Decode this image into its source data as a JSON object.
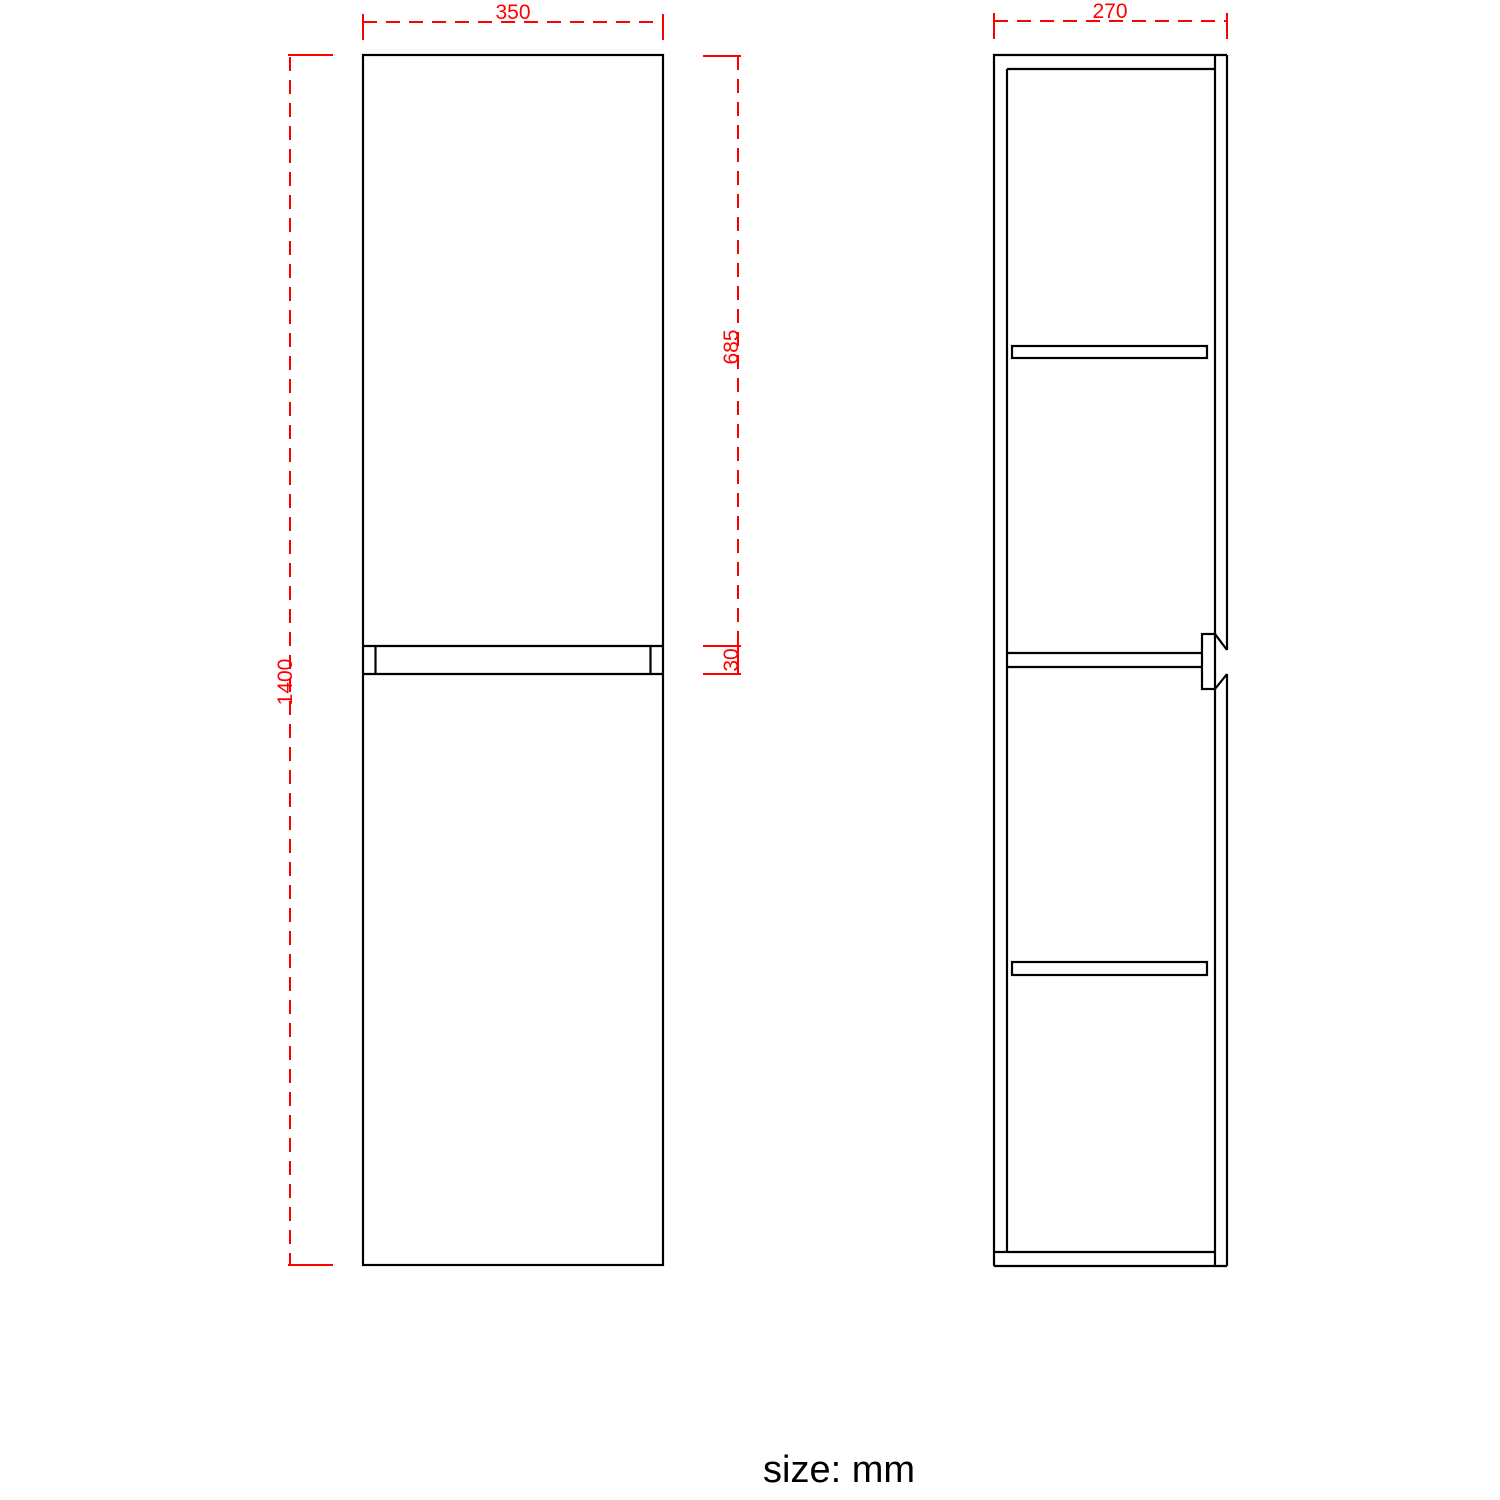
{
  "drawing": {
    "dimensions": {
      "front_width_mm": "350",
      "front_height_mm": "1400",
      "upper_door_height_mm": "685",
      "door_gap_mm": "30",
      "side_depth_mm": "270"
    },
    "footer": {
      "units_label": "size: mm"
    },
    "colors": {
      "outline": "#000000",
      "dimension": "#ff0000",
      "text": "#000000"
    }
  }
}
